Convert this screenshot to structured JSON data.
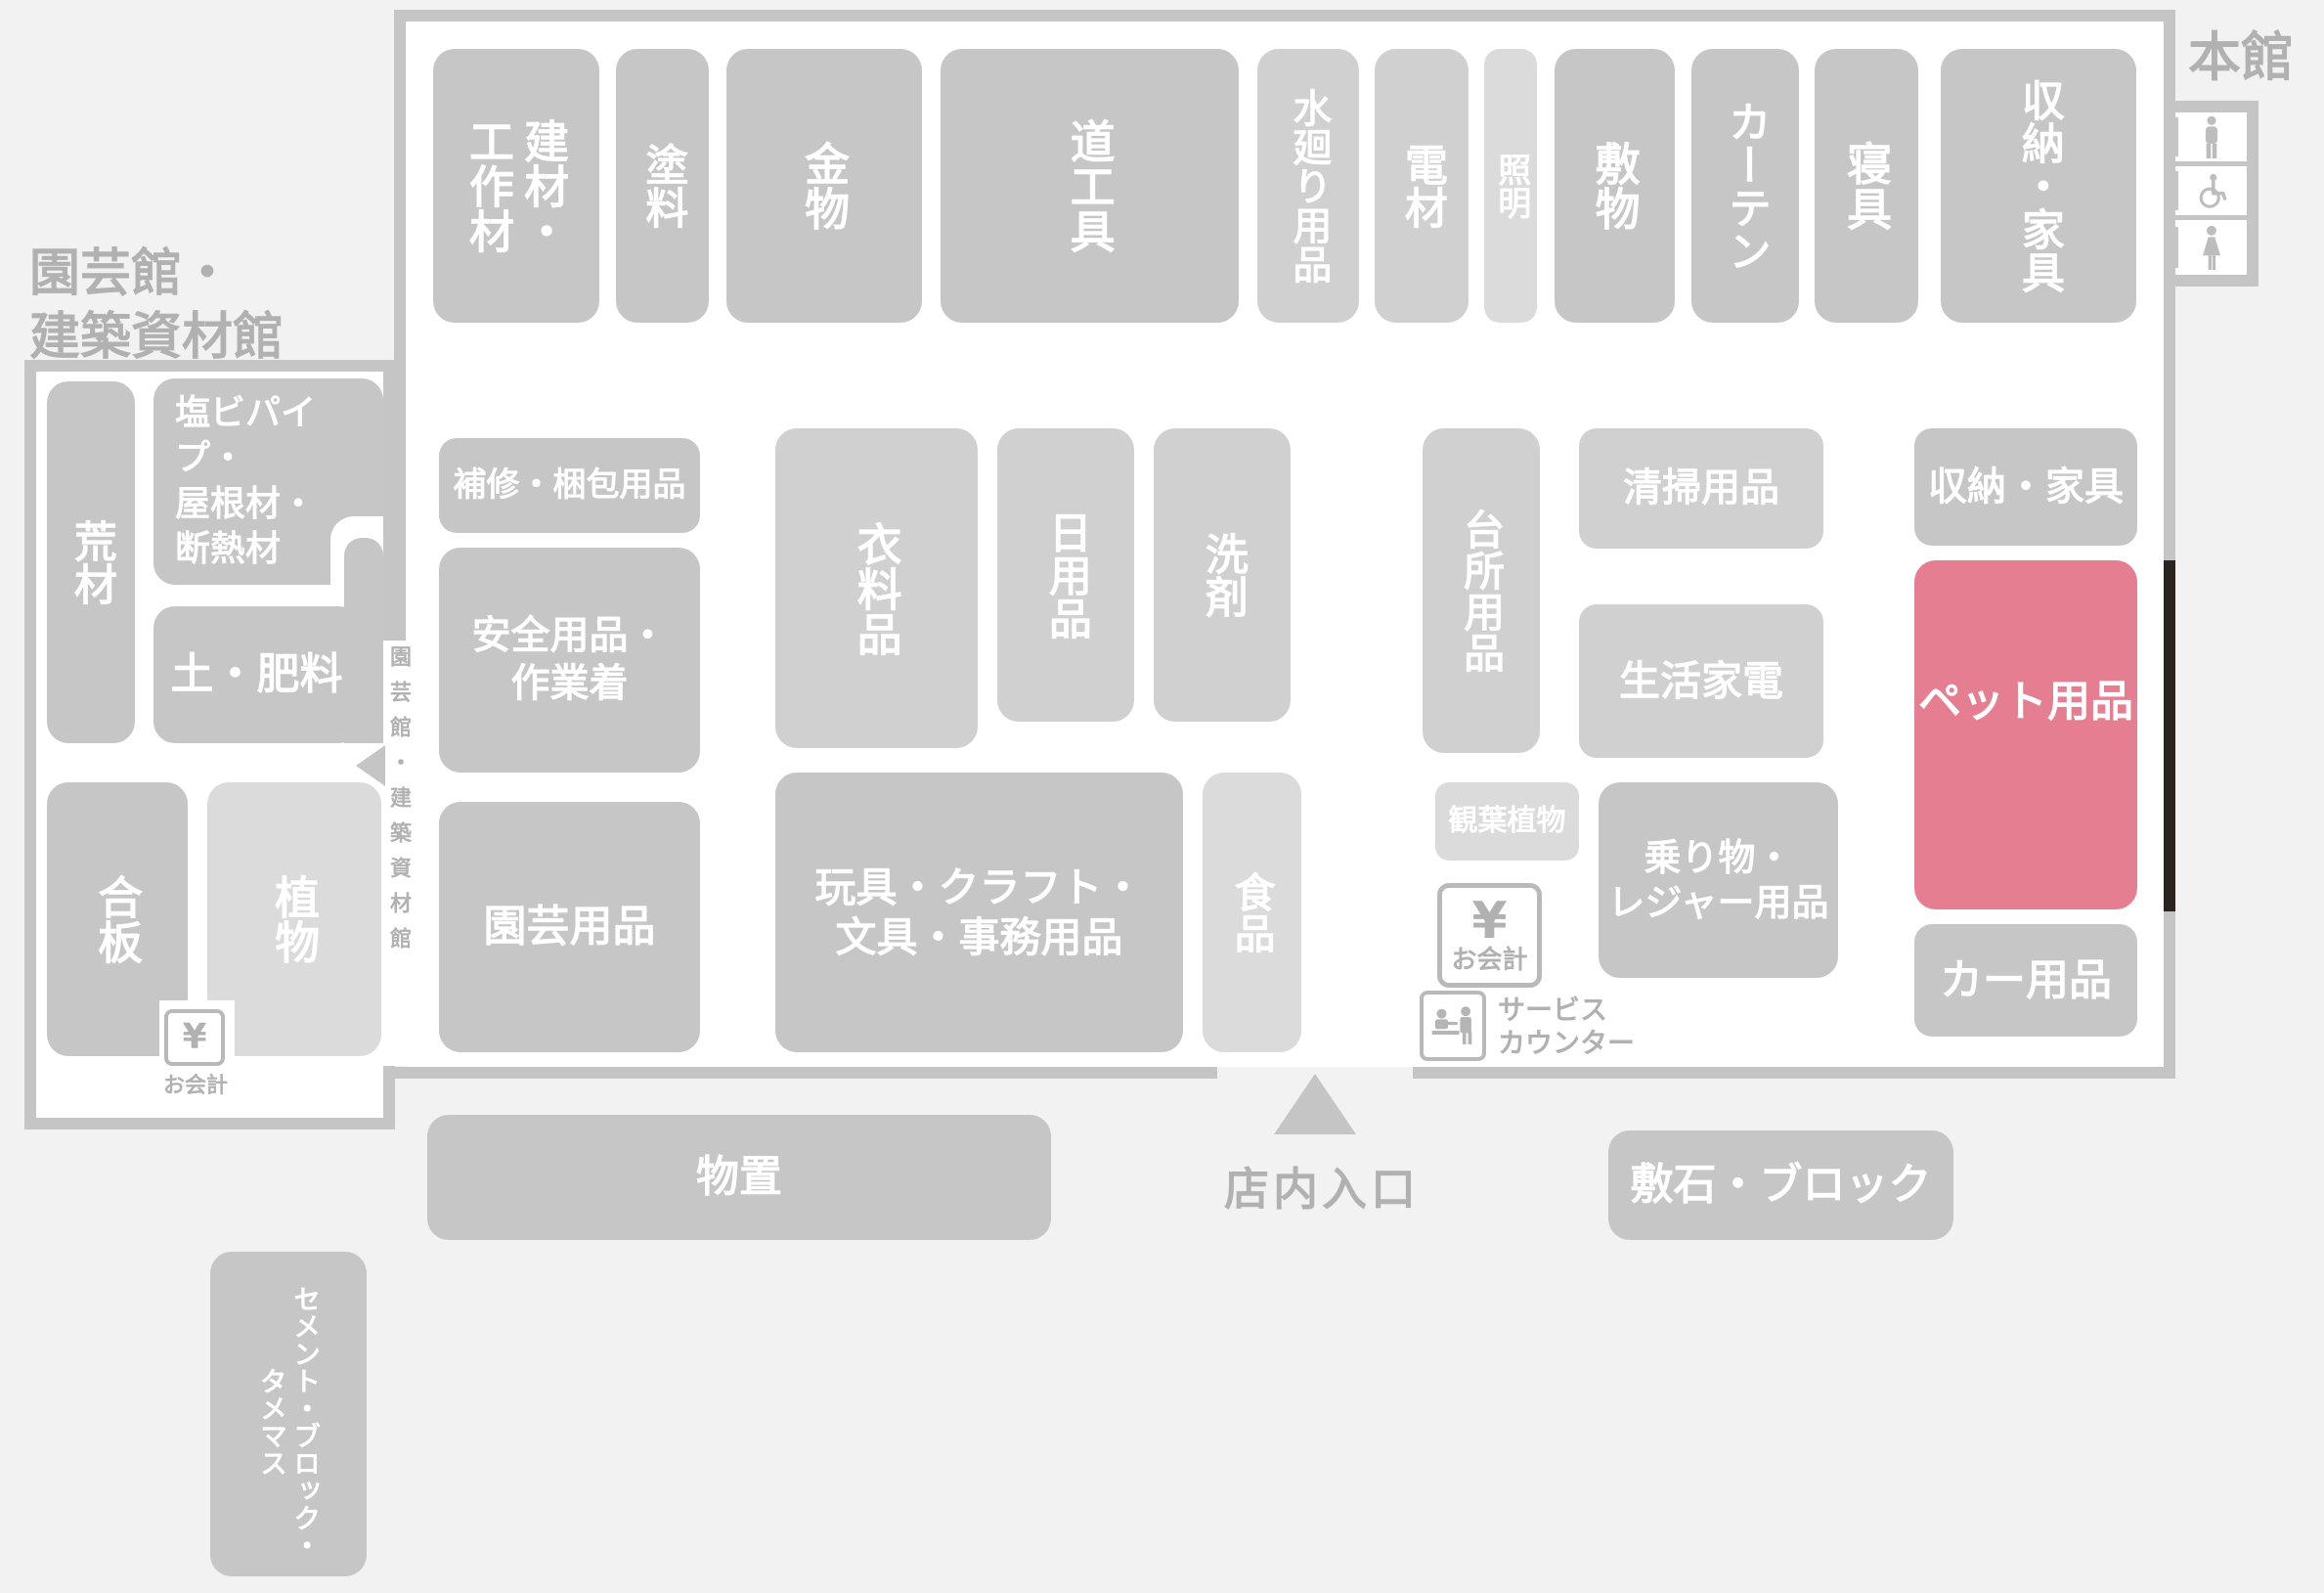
{
  "colors": {
    "background": "#f2f2f2",
    "interior": "#ffffff",
    "wall": "#c5c5c5",
    "block_dark": "#c6c6c6",
    "block_mid": "#d0d0d0",
    "block_light": "#dbdbdb",
    "highlight": "#e57e90",
    "door_marker": "#2b2421",
    "label_text": "#b1b1b1",
    "block_text": "#ffffff"
  },
  "buildings": {
    "main": {
      "title": "本館"
    },
    "annex": {
      "title": "園芸館・\n建築資材館"
    }
  },
  "blocks": {
    "kenzai": {
      "label": "建材・\n工作材"
    },
    "toryo": {
      "label": "塗料"
    },
    "kanamono": {
      "label": "金物"
    },
    "dogu": {
      "label": "道工具"
    },
    "mizumawari": {
      "label": "水廻り用品"
    },
    "denzai": {
      "label": "電材"
    },
    "shomei": {
      "label": "照明"
    },
    "shikimono": {
      "label": "敷物"
    },
    "curtain": {
      "label": "カーテン"
    },
    "shingu": {
      "label": "寝具"
    },
    "shuno_top": {
      "label": "収納・家具"
    },
    "hoshu": {
      "label": "補修・梱包用品"
    },
    "anzen": {
      "label": "安全用品・\n作業着"
    },
    "iryohin": {
      "label": "衣料品"
    },
    "nichiyohin": {
      "label": "日用品"
    },
    "senzai": {
      "label": "洗剤"
    },
    "daidokoro": {
      "label": "台所用品"
    },
    "seiso": {
      "label": "清掃用品"
    },
    "kaden": {
      "label": "生活家電"
    },
    "shuno_right": {
      "label": "収納・家具"
    },
    "pet": {
      "label": "ペット用品",
      "highlighted": true
    },
    "norimono": {
      "label": "乗り物・\nレジャー用品"
    },
    "kanyo": {
      "label": "観葉植物"
    },
    "engei": {
      "label": "園芸用品"
    },
    "gangu": {
      "label": "玩具・クラフト・\n文具・事務用品"
    },
    "shokuhin": {
      "label": "食品"
    },
    "car": {
      "label": "カー用品"
    },
    "monooki": {
      "label": "物置"
    },
    "shikiishi": {
      "label": "敷石・ブロック"
    },
    "cement": {
      "label": "セメント・ブロック・\nタメマス"
    },
    "arazai": {
      "label": "荒材"
    },
    "enbi": {
      "label": "塩ビパイプ・\n屋根材・\n断熱材"
    },
    "tsuchi": {
      "label": "土・肥料"
    },
    "gohan": {
      "label": "合板"
    },
    "shokubutsu": {
      "label": "植物"
    }
  },
  "facilities": {
    "entrance": {
      "label": "店内入口"
    },
    "passage": {
      "label": "園芸館・建築資材館"
    },
    "service_counter": {
      "label": "サービス\nカウンター"
    },
    "checkout_main": {
      "symbol": "¥",
      "label": "お会計"
    },
    "checkout_annex": {
      "symbol": "¥",
      "label": "お会計"
    },
    "restrooms": [
      "male-restroom-icon",
      "wheelchair-accessible-icon",
      "female-restroom-icon"
    ]
  }
}
